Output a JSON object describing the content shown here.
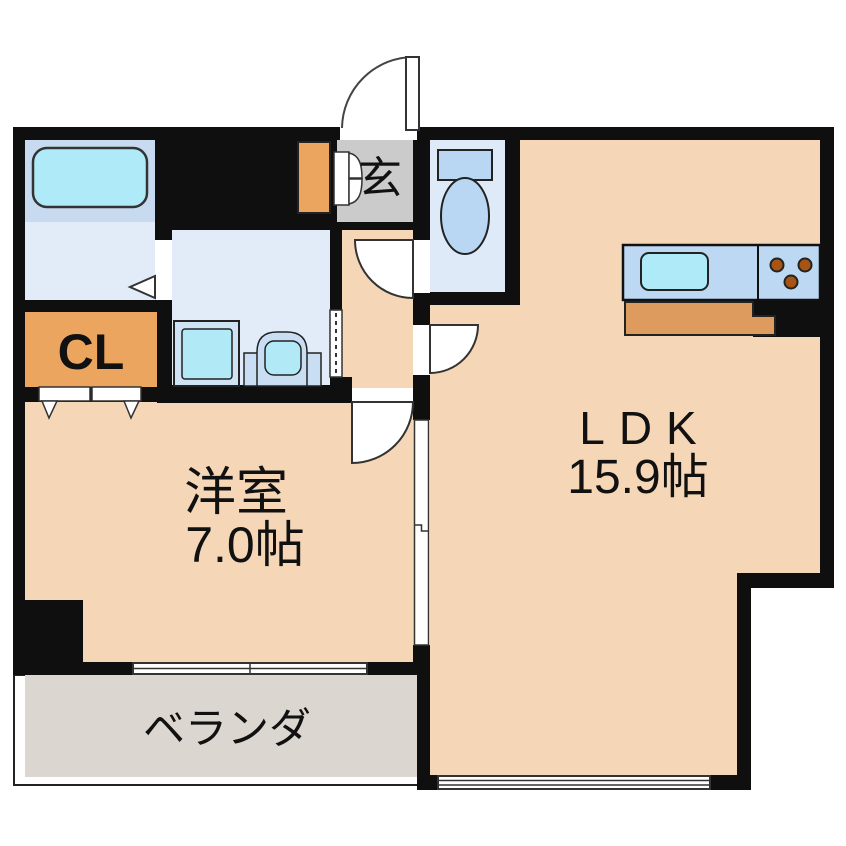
{
  "floorplan": {
    "labels": {
      "entrance": "玄",
      "closet": "CL",
      "western_room_name": "洋室",
      "western_room_size": "7.0帖",
      "ldk_name": "LDK",
      "ldk_size": "15.9帖",
      "veranda": "ベランダ"
    },
    "colors": {
      "wall": "#0f0f0f",
      "room_floor": "#f5d7b8",
      "entrance_floor": "#cbcbcb",
      "veranda_floor": "#dcd6d0",
      "bathroom_floor": "#c8daf0",
      "wet_area_floor": "#e1ecf8",
      "toilet_floor": "#dfeaf8",
      "fixture_blue": "#b9d7f2",
      "water_cyan": "#aeeaf8",
      "closet_orange": "#eca55f",
      "cabinet_orange": "#dd9c5e",
      "burner_brown": "#a85413"
    },
    "fixtures": [
      "bathtub",
      "washing-machine-pan",
      "vanity-sink",
      "toilet",
      "kitchen-sink",
      "stove-burners",
      "kitchen-cabinet",
      "shoe-cabinet"
    ]
  }
}
